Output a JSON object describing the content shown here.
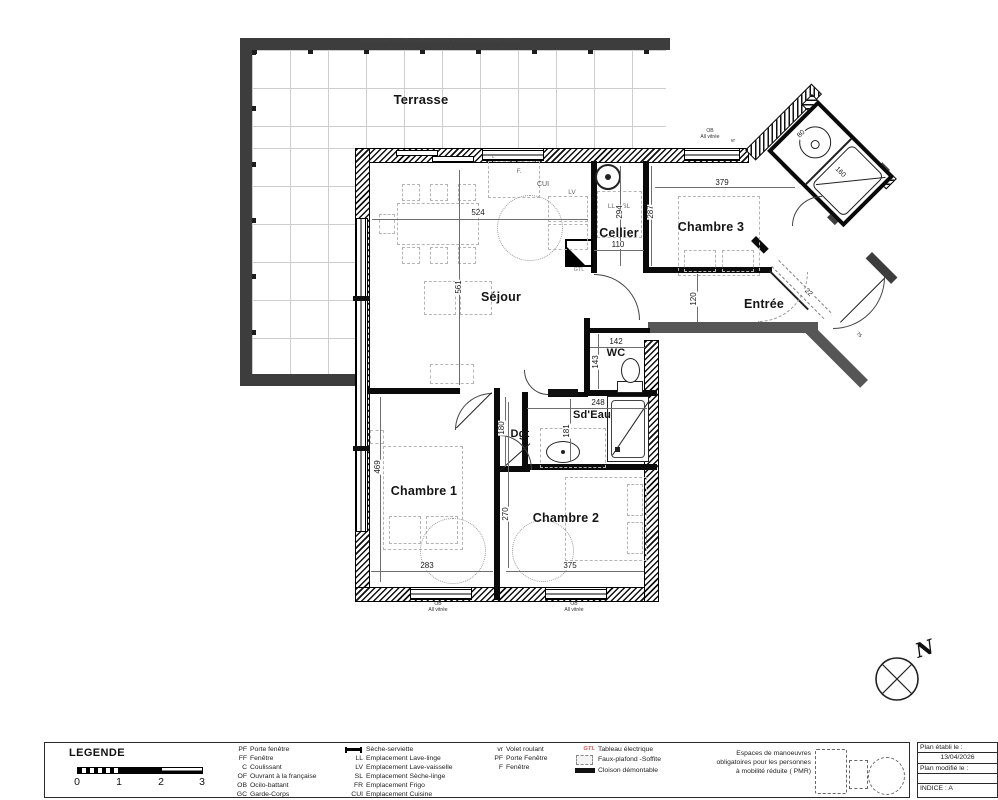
{
  "meta": {
    "garde_corps_note": "Garde corps ht 1.00m + Muret 0.60m + lisses horizontales 0.45m",
    "north_label": "N"
  },
  "rooms": {
    "terrasse": "Terrasse",
    "sejour": "Séjour",
    "cellier": "Cellier",
    "chambre3": "Chambre 3",
    "entree": "Entrée",
    "wc": "WC",
    "sdeau": "Sd'Eau",
    "dgt": "Dgt",
    "chambre1": "Chambre 1",
    "chambre2": "Chambre 2"
  },
  "dims": {
    "sejour_w": "524",
    "sejour_h": "561",
    "cellier_w": "110",
    "cellier_h": "294",
    "ch3_w": "379",
    "ch3_h": "287",
    "entree_h": "120",
    "wc_w": "142",
    "wc_h": "143",
    "sdeau_w": "248",
    "sdeau_h": "181",
    "dgt_h": "180",
    "ch1_h": "469",
    "ch1_w": "283",
    "ch2_h": "270",
    "ch2_w": "375",
    "bath_w": "80",
    "bath_l": "160",
    "entry_a": "22",
    "entry_b": "75"
  },
  "annotations": {
    "cui": "CUI",
    "fridge": "F.",
    "lave_vaisselle": "LV",
    "lave_linge_seche_linge": "LL + SL",
    "gtl": "GTL",
    "volet_roulant": "vr",
    "coulissant": "c",
    "ob": "OB",
    "all_vitree": "All vitrée"
  },
  "legend": {
    "title": "LEGENDE",
    "scale_ticks": [
      "0",
      "1",
      "2",
      "3"
    ],
    "openings": [
      [
        "PF",
        "Porte fenêtre"
      ],
      [
        "FF",
        "Fenêtre"
      ],
      [
        "C",
        "Coulissant"
      ],
      [
        "OF",
        "Ouvrant à la française"
      ],
      [
        "OB",
        "Ocilo-battant"
      ],
      [
        "GC",
        "Garde-Corps"
      ]
    ],
    "equipment_icon_label": "Sèche-serviette",
    "equipment": [
      [
        "LL",
        "Emplacement Lave-linge"
      ],
      [
        "LV",
        "Emplacement Lave-vaisselle"
      ],
      [
        "SL",
        "Emplacement Sèche-linge"
      ],
      [
        "FR",
        "Emplacement Frigo"
      ],
      [
        "CUI",
        "Emplacement Cuisine"
      ]
    ],
    "misc": [
      [
        "vr",
        "Volet roulant"
      ],
      [
        "PF",
        "Porte Fenêtre"
      ],
      [
        "F",
        "Fenêtre"
      ]
    ],
    "gtl_abbr": "GTL",
    "gtl_label": "Tableau électrique",
    "faux_plafond_label": "Faux-plafond -Soffite",
    "cloison_label": "Cloison démontable",
    "pmr_lines": [
      "Espaces de manoeuvres",
      "obligatoires pour les personnes",
      "à mobilité réduite ( PMR)"
    ]
  },
  "info_box": {
    "established_label": "Plan établi le :",
    "established_date": "13/04/2026",
    "modified_label": "Plan modifié le :",
    "modified_value": "",
    "indice": "INDICE : A"
  }
}
